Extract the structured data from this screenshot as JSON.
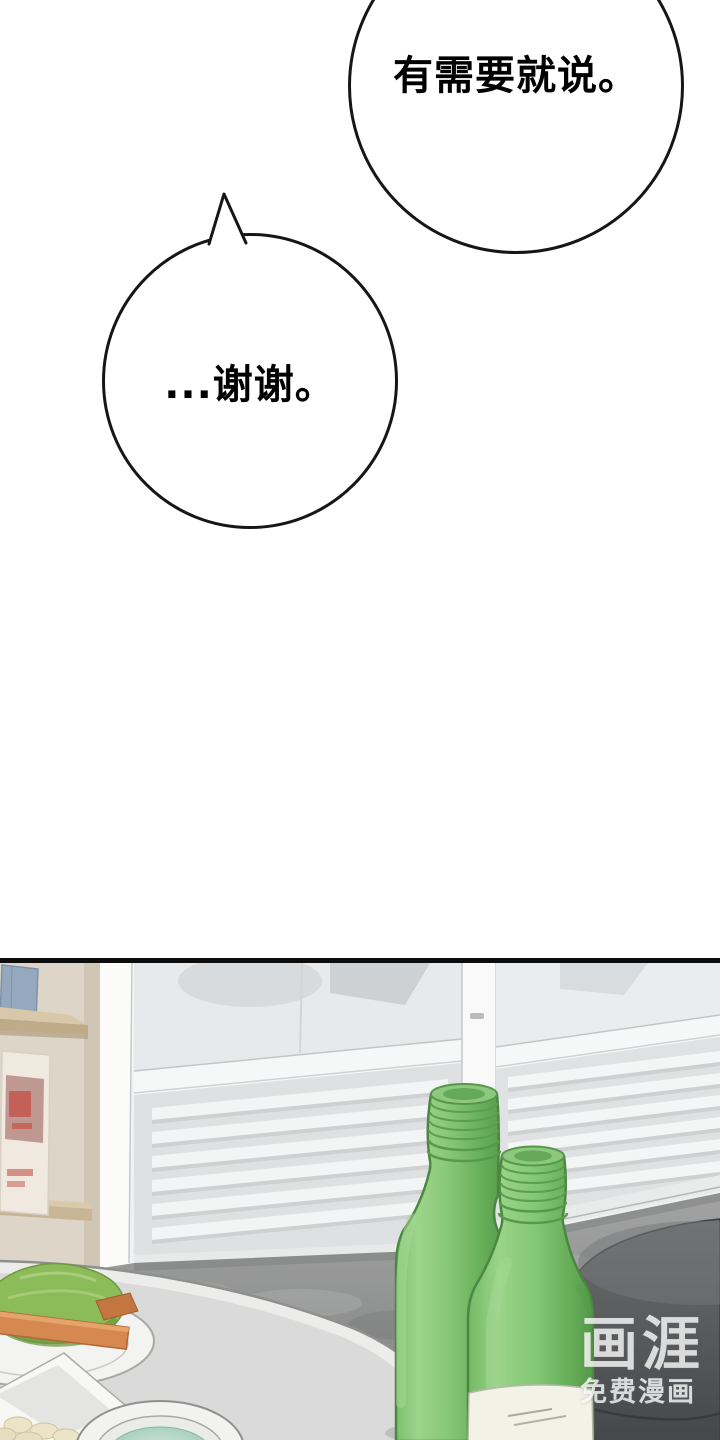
{
  "bubbles": {
    "top": {
      "text": "有需要就说。"
    },
    "reply": {
      "text": "...谢谢。"
    }
  },
  "watermark": {
    "logo": "画涯",
    "tagline": "免费漫画"
  },
  "panel": {
    "objects": [
      "sliding-door",
      "vent-slats",
      "wall-shelf",
      "poster",
      "round-table",
      "lettuce-plate",
      "garlic-bowl",
      "soup-bowl",
      "soju-bottle",
      "soju-bottle",
      "stool"
    ],
    "colors": {
      "panel_border": "#0d0d0d",
      "bottle_green": "#79bd68",
      "bottle_highlight": "#a6d996",
      "bottle_shadow": "#549a48",
      "door_white": "#f5f6f6",
      "floor_gray": "#939493",
      "table_gray": "#d9dad9",
      "stool_gray": "#58595b",
      "wall_beige": "#ddd5c7",
      "lettuce_green": "#8cbb59",
      "carrot_orange": "#d5884f",
      "soup_teal": "#a3ccba"
    }
  }
}
